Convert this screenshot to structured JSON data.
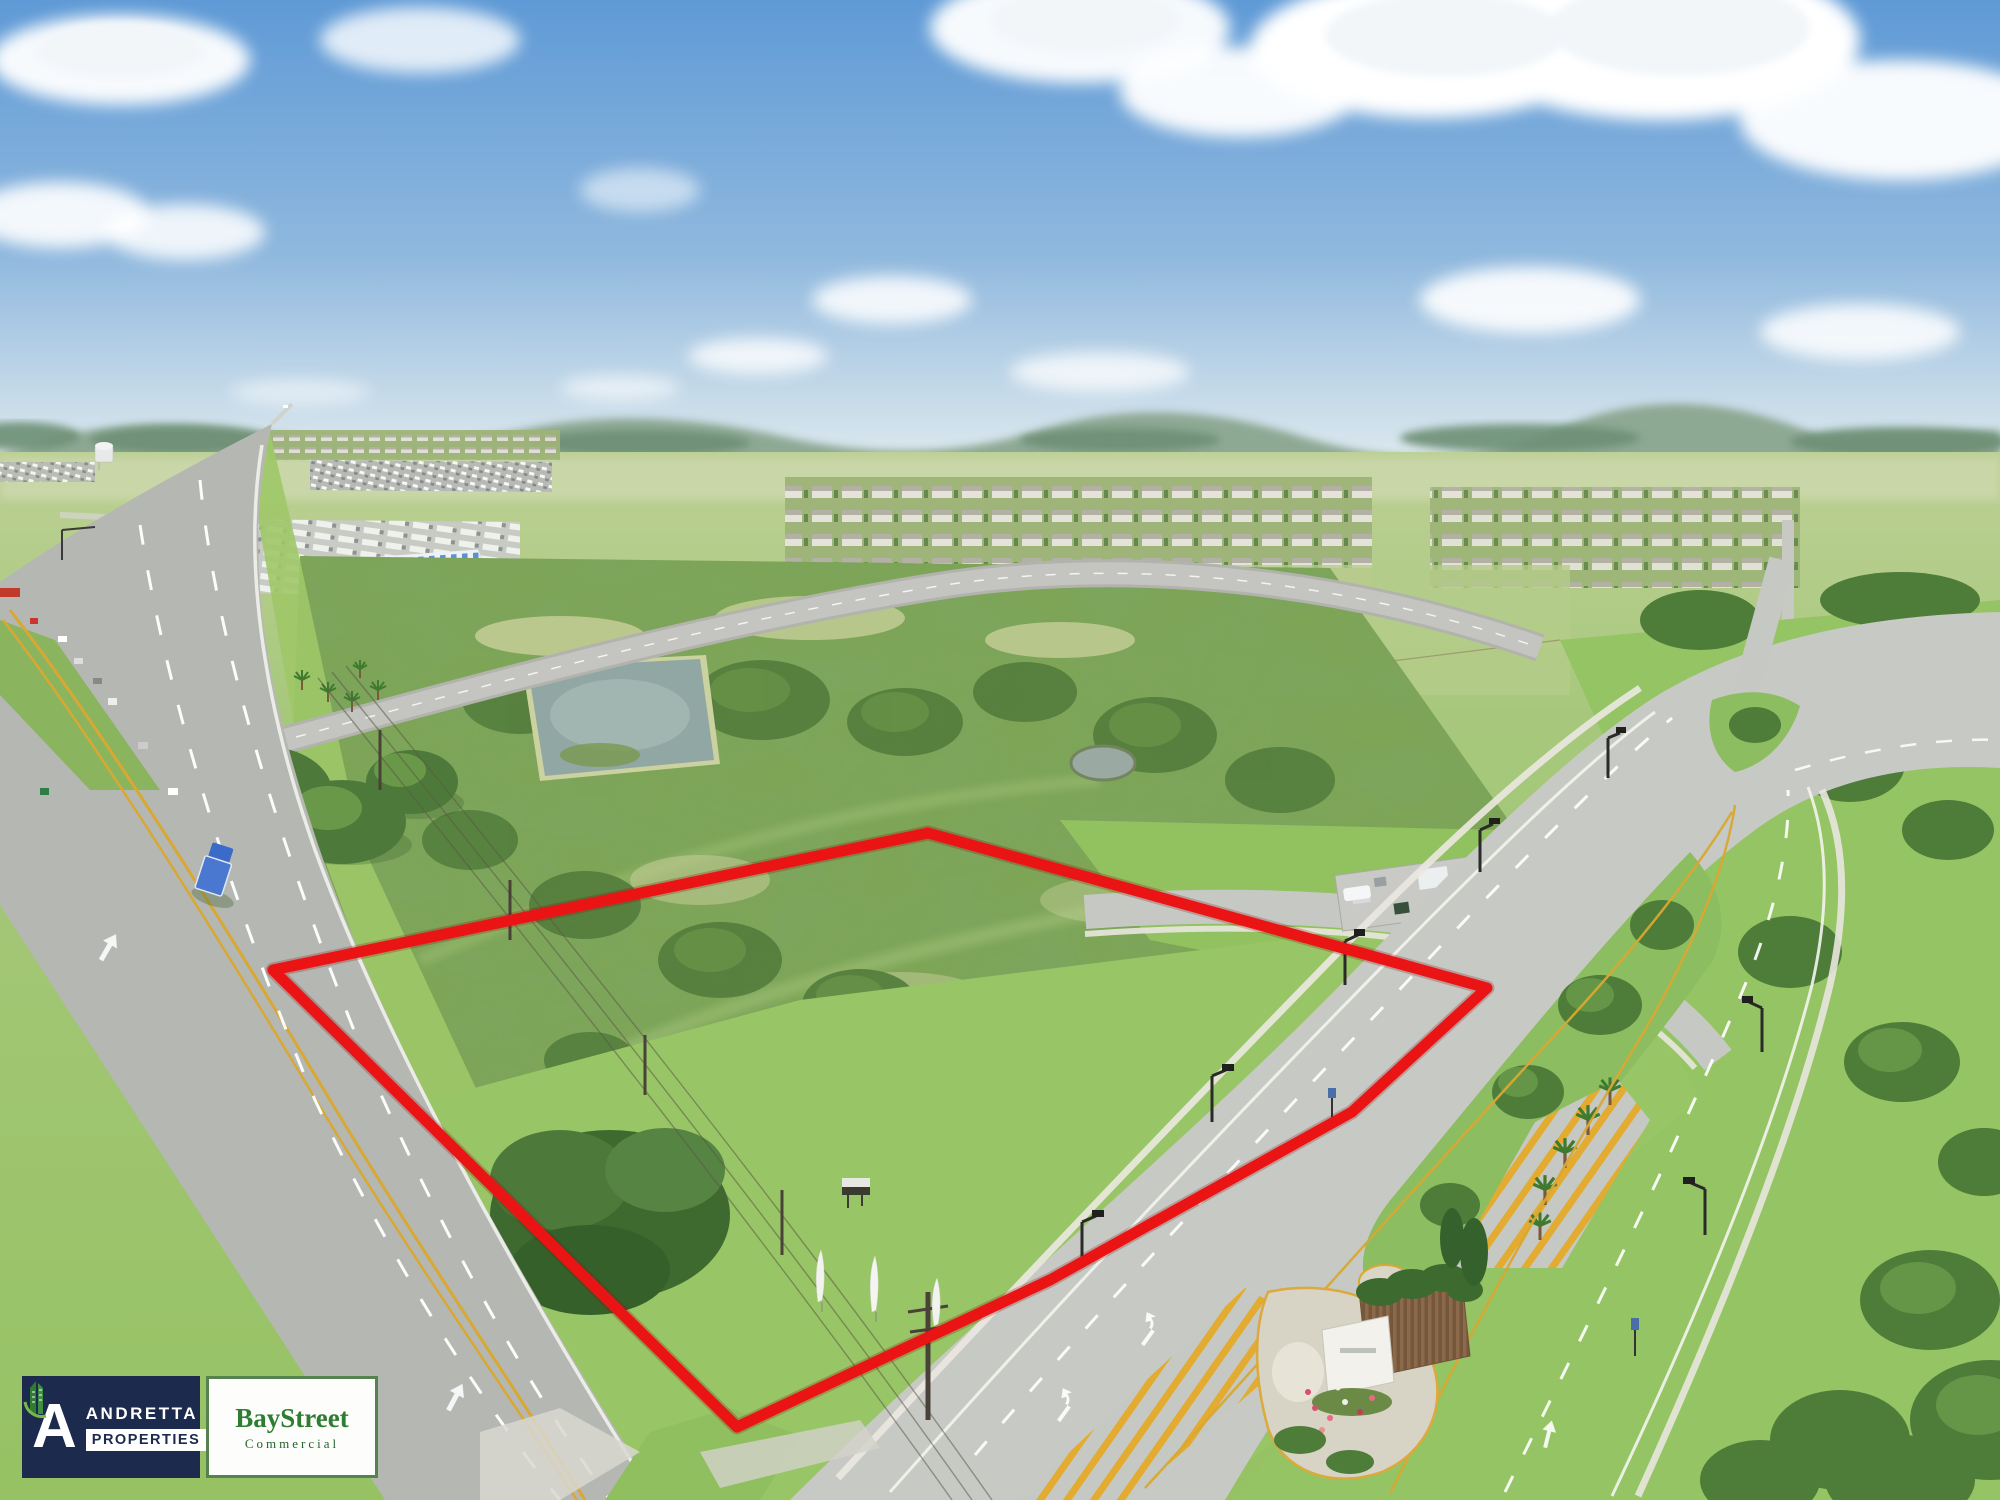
{
  "page": {
    "title": "Aerial land parcel marketing photo"
  },
  "branding": {
    "andretta": {
      "initial": "A",
      "name": "ANDRETTA",
      "subtitle": "PROPERTIES",
      "bg": "#1c2b4d",
      "text": "#ffffff"
    },
    "baystreet": {
      "name": "BayStreet",
      "subtitle": "Commercial",
      "green": "#2e7d32",
      "dark_green": "#23642c",
      "border": "#55824f"
    }
  },
  "scene": {
    "boundary_color": "#ea1414",
    "sky_top": "#5f9ad6",
    "sky_mid": "#8fb8de",
    "sky_horizon": "#dde9ee",
    "grass_bright": "#97c464",
    "scrub_green": "#7ea556",
    "asphalt": "#b5b7b3",
    "new_asphalt": "#c7c9c4",
    "lane_yellow": "#d9a832",
    "elements": [
      "aerial drone photo",
      "red outlined vacant land parcel",
      "US highway with traffic",
      "divided entrance boulevard",
      "retention pond",
      "distant subdivisions",
      "truck and trailer yard",
      "blue striped warehouse",
      "palm trees",
      "power lines",
      "feather flags",
      "community entrance monument with flowers"
    ]
  }
}
